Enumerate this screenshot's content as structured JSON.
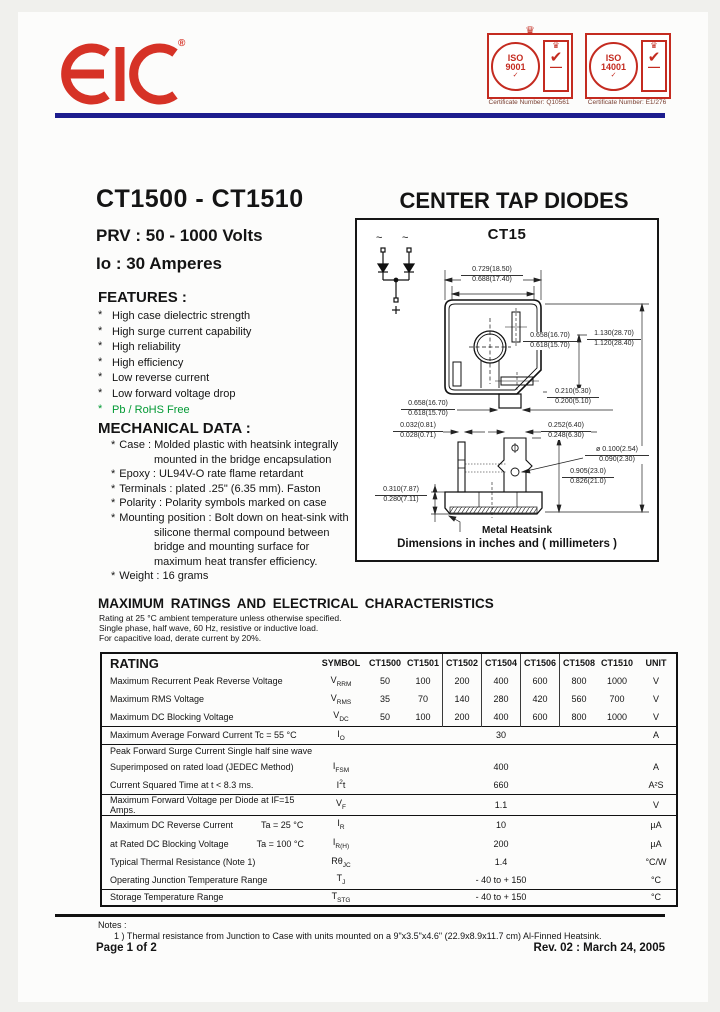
{
  "header": {
    "logo": "EIC",
    "reg": "®",
    "badges": [
      {
        "iso": "ISO",
        "num": "9001",
        "tick": "✓",
        "crown": "♛",
        "check": "✔",
        "cert": "Certificate Number: Q10561"
      },
      {
        "iso": "ISO",
        "num": "14001",
        "tick": "✓",
        "crown": "♛",
        "check": "✔",
        "cert": "Certificate Number: E1/276"
      }
    ]
  },
  "title": {
    "part": "CT1500 - CT1510",
    "category": "CENTER TAP DIODES",
    "prv": "PRV : 50 - 1000 Volts",
    "io": "Io : 30 Amperes"
  },
  "features": {
    "heading": "FEATURES :",
    "bullet": "*",
    "items": [
      "High case dielectric strength",
      "High surge current capability",
      "High reliability",
      "High efficiency",
      "Low reverse current",
      "Low forward voltage drop",
      "Pb / RoHS Free"
    ],
    "green_color": "#009933"
  },
  "mechanical": {
    "heading": "MECHANICAL  DATA :",
    "items": [
      "Case : Molded plastic with heatsink integrally mounted in the bridge encapsulation",
      "Epoxy : UL94V-O rate flame retardant",
      "Terminals : plated .25\" (6.35 mm). Faston",
      "Polarity : Polarity symbols marked on case",
      "Mounting  position : Bolt down on heat-sink with silicone thermal compound between bridge and mounting surface for maximum heat transfer efficiency.",
      "Weight :  16 grams"
    ]
  },
  "package": {
    "name": "CT15",
    "caption": "Dimensions in inches and ( millimeters )",
    "heatsink_label": "Metal Heatsink",
    "schematic": {
      "ac1": "~",
      "ac2": "~",
      "plus": "+"
    },
    "dims": {
      "d1": {
        "top": "0.729(18.50)",
        "bot": "0.688(17.40)"
      },
      "d2": {
        "top": "0.658(16.70)",
        "bot": "0.618(15.70)"
      },
      "d3": {
        "top": "1.130(28.70)",
        "bot": "1.120(28.40)"
      },
      "d4": {
        "top": "0.210(5.30)",
        "bot": "0.200(5.10)"
      },
      "d5": {
        "top": "0.658(16.70)",
        "bot": "0.618(15.70)"
      },
      "d6": {
        "top": "0.032(0.81)",
        "bot": "0.028(0.71)"
      },
      "d7": {
        "top": "0.252(6.40)",
        "bot": "0.248(6.30)"
      },
      "d8": {
        "top": "ø 0.100(2.54)",
        "bot": "0.090(2.30)"
      },
      "d9": {
        "top": "0.905(23.0)",
        "bot": "0.826(21.0)"
      },
      "d10": {
        "top": "0.310(7.87)",
        "bot": "0.280(7.11)"
      }
    }
  },
  "ratings": {
    "heading": "MAXIMUM  RATINGS  AND  ELECTRICAL  CHARACTERISTICS",
    "subtitle": [
      "Rating at  25 °C ambient temperature unless otherwise specified.",
      "Single phase, half wave, 60 Hz, resistive or inductive load.",
      "For capacitive load, derate current by 20%."
    ],
    "table": {
      "col_rating": "RATING",
      "col_symbol": "SYMBOL",
      "col_parts": [
        "CT1500",
        "CT1501",
        "CT1502",
        "CT1504",
        "CT1506",
        "CT1508",
        "CT1510"
      ],
      "col_unit": "UNIT",
      "rows": {
        "r1": {
          "label": "Maximum Recurrent Peak Reverse Voltage",
          "sym_pre": "V",
          "sym_sub": "RRM",
          "v": [
            "50",
            "100",
            "200",
            "400",
            "600",
            "800",
            "1000"
          ],
          "unit": "V"
        },
        "r2": {
          "label": "Maximum RMS Voltage",
          "sym_pre": "V",
          "sym_sub": "RMS",
          "v": [
            "35",
            "70",
            "140",
            "280",
            "420",
            "560",
            "700"
          ],
          "unit": "V"
        },
        "r3": {
          "label": "Maximum DC Blocking Voltage",
          "sym_pre": "V",
          "sym_sub": "DC",
          "v": [
            "50",
            "100",
            "200",
            "400",
            "600",
            "800",
            "1000"
          ],
          "unit": "V"
        },
        "r4": {
          "label": "Maximum Average Forward Current Tc = 55 °C",
          "sym_pre": "I",
          "sym_sub": "O",
          "value": "30",
          "unit": "A"
        },
        "r5a": {
          "label": "Peak Forward Surge Current Single half sine wave"
        },
        "r5b": {
          "label": "Superimposed on rated load (JEDEC Method)",
          "sym_pre": "I",
          "sym_sub": "FSM",
          "value": "400",
          "unit": "A"
        },
        "r6": {
          "label": "Current Squared Time at  t < 8.3 ms.",
          "sym_pre": "I",
          "sym_sup": "2",
          "sym_post": "t",
          "value": "660",
          "unit": "A²S"
        },
        "r7": {
          "label": "Maximum Forward Voltage per Diode at IF=15 Amps.",
          "sym_pre": "V",
          "sym_sub": "F",
          "value": "1.1",
          "unit": "V"
        },
        "r8": {
          "label": "Maximum DC Reverse Current",
          "cond": "Ta = 25 °C",
          "sym_pre": "I",
          "sym_sub": "R",
          "value": "10",
          "unit": "µA"
        },
        "r9": {
          "label": "at Rated DC Blocking Voltage",
          "cond": "Ta = 100 °C",
          "sym_pre": "I",
          "sym_sub": "R(H)",
          "value": "200",
          "unit": "µA"
        },
        "r10": {
          "label": "Typical Thermal Resistance (Note 1)",
          "sym_pre": "Rθ",
          "sym_sub": "JC",
          "value": "1.4",
          "unit": "°C/W"
        },
        "r11": {
          "label": "Operating Junction Temperature Range",
          "sym_pre": "T",
          "sym_sub": "J",
          "value": "- 40 to + 150",
          "unit": "°C"
        },
        "r12": {
          "label": "Storage Temperature Range",
          "sym_pre": "T",
          "sym_sub": "STG",
          "value": "- 40 to + 150",
          "unit": "°C"
        }
      }
    }
  },
  "notes": {
    "heading": "Notes :",
    "note1": "1 )  Thermal resistance from Junction to Case with units mounted on a 9\"x3.5\"x4.6\" (22.9x8.9x11.7 cm) Al-Finned Heatsink."
  },
  "footer": {
    "page": "Page 1 of 2",
    "rev": "Rev. 02 : March 24, 2005"
  }
}
